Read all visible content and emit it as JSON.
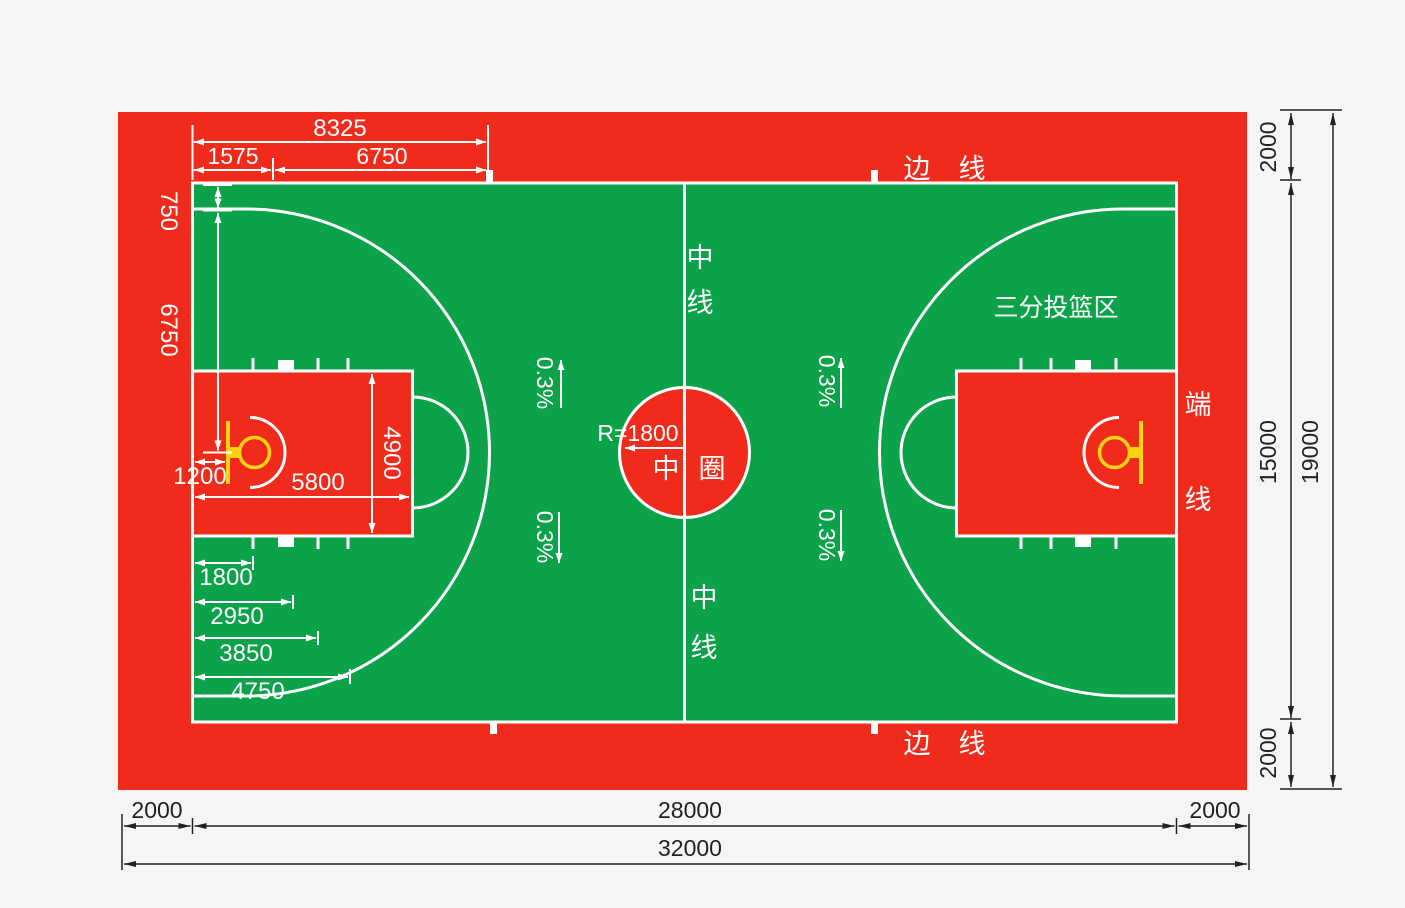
{
  "labels": {
    "sideline": [
      "边",
      "线"
    ],
    "endline": [
      "端",
      "线"
    ],
    "center_line": [
      "中",
      "线"
    ],
    "center_circle": [
      "中",
      "圈"
    ],
    "three_point_area": "三分投篮区",
    "center_radius": "R=1800",
    "slope": "0.3%"
  },
  "dimensions": {
    "top": {
      "endline_to_arc_top": "8325",
      "endline_to_hoop": "1575",
      "three_point_radius": "6750"
    },
    "left": {
      "sideline_to_line": "750",
      "to_court_axis": "6750"
    },
    "paint": {
      "hoop_offset": "1200",
      "length": "5800",
      "width": "4900"
    },
    "lane_marks": [
      "1800",
      "2950",
      "3850",
      "4750"
    ],
    "right": {
      "buffer_top": "2000",
      "court_width": "15000",
      "overall_width": "19000",
      "buffer_bottom": "2000"
    },
    "bottom": {
      "buffer_left": "2000",
      "court_length": "28000",
      "overall_length": "32000",
      "buffer_right": "2000"
    }
  },
  "colors": {
    "buffer_red": "#f02b1b",
    "court_green": "#0ba24a",
    "marking_white": "#ffffff",
    "hoop_yellow": "#f8d410",
    "dimension_black": "#222222"
  }
}
